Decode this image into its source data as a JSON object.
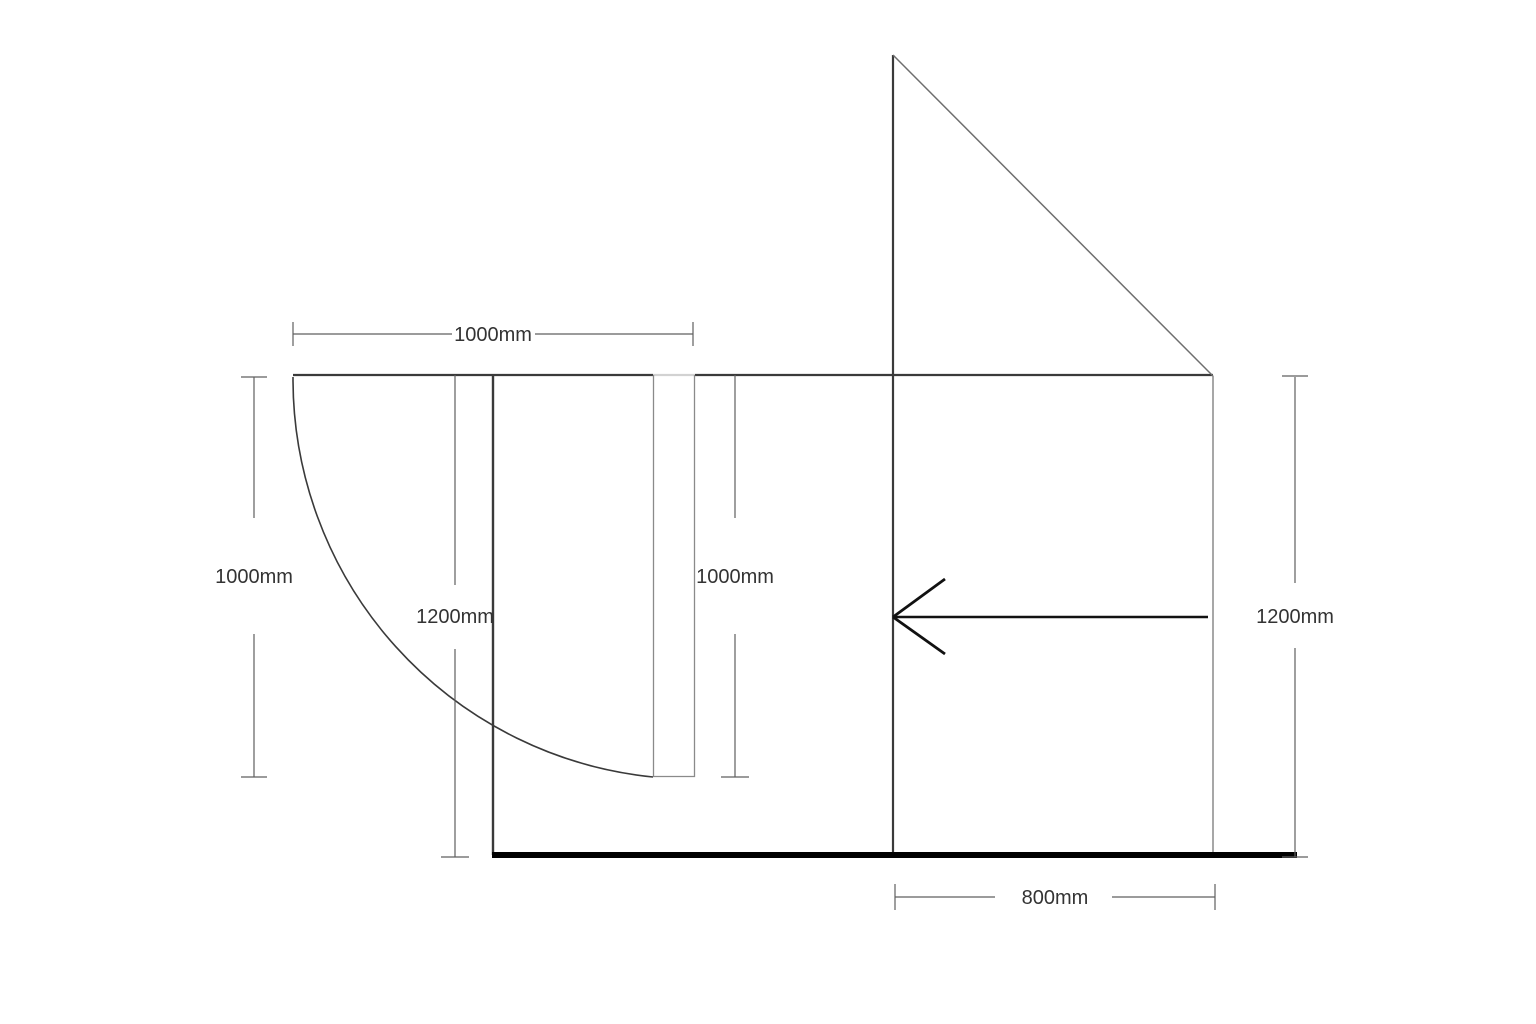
{
  "drawing": {
    "title": "door-elevation-technical-drawing",
    "dimension_labels": {
      "top_width": "1000mm",
      "left_height": "1000mm",
      "mid_left_height": "1200mm",
      "mid_right_height": "1000mm",
      "right_height": "1200mm",
      "bottom_width": "800mm"
    },
    "colors": {
      "wall": "#3a3a3a",
      "slope": "#6e6e6e",
      "side_wall": "#8a8a8a",
      "door_gap": "#d2d2d2",
      "door_leaf": "#8a8a8a",
      "swing_arc": "#3a3a3a",
      "dimension_line": "#5f5f5f",
      "arrow": "#111111",
      "floor": "#000000",
      "label_text": "#333333",
      "background": "#ffffff"
    }
  }
}
